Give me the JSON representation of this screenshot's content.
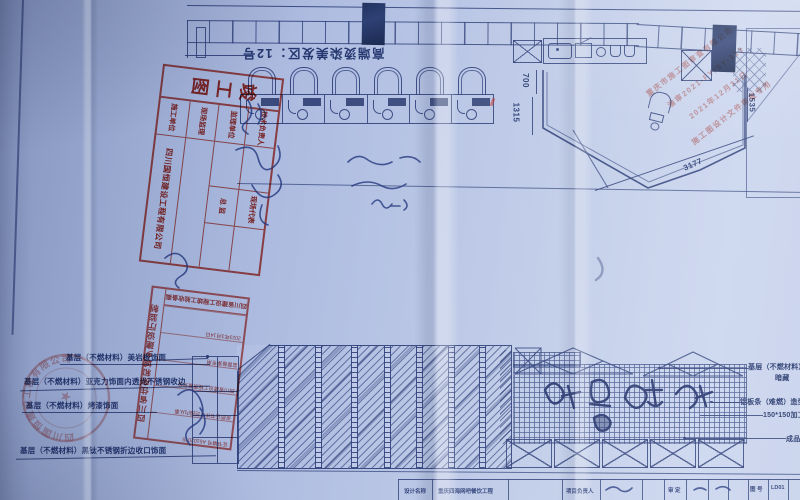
{
  "colors": {
    "paper": "#b6c3e4",
    "ink": "#2c3e78",
    "stamp_red": "#ba281e",
    "signature_blue": "#24387f"
  },
  "plan": {
    "title": "高端烫染美发区：12号",
    "dim_700": "700",
    "dim_1315": "1315",
    "dim_1535": "1535",
    "dim_3177": "3177"
  },
  "callouts": {
    "left": [
      "基层（不燃材料）美岩板饰面",
      "基层（不燃材料）亚克力饰面内透光不锈钢收边",
      "基层（不燃材料）烤漆饰面",
      "基层（不燃材料）黑钛不锈钢折边收口饰面"
    ],
    "right": [
      "基层（不燃材料）木饰面金属",
      "暗藏",
      "铝板条（难燃）造型喷黑烤漆亚克力",
      "150*150加工厂",
      "成品木"
    ]
  },
  "stamps": {
    "as_built": {
      "title": "竣工图",
      "r1c1": "技术负责人",
      "r1c3": "现场代表",
      "r2c1": "监理单位",
      "r2c3": "总  监",
      "r3c1": "现场监理",
      "r4c1": "施工单位",
      "company": "四川国恒建设工程有限公司"
    },
    "authority": {
      "edge": "四川省住房和城乡建设厅监制",
      "header": "四川省建设工程竣工验收备案",
      "l1": "证书编号 A5102075",
      "l2": "资质证书许可范围内从事",
      "l3": "四川省建设工程质量安全",
      "l4": "监督备案专用",
      "l5": "2023年3月14日"
    },
    "review": {
      "l1": "重庆市施工图审查有限公司",
      "l2": "渝审2021-FY/SY-313",
      "l3": "2021年12月31日",
      "l4": "施工图设计文件审查专用"
    },
    "company_seal": {
      "ring": "四川国恒建设工程有限公司",
      "star": "★"
    }
  },
  "title_block": {
    "c1": "设计名称",
    "c2": "重庆四海网吧餐饮工程",
    "c3": "项目负责人",
    "c4": "审 定",
    "c5": "图 号",
    "c6": "LD01"
  }
}
